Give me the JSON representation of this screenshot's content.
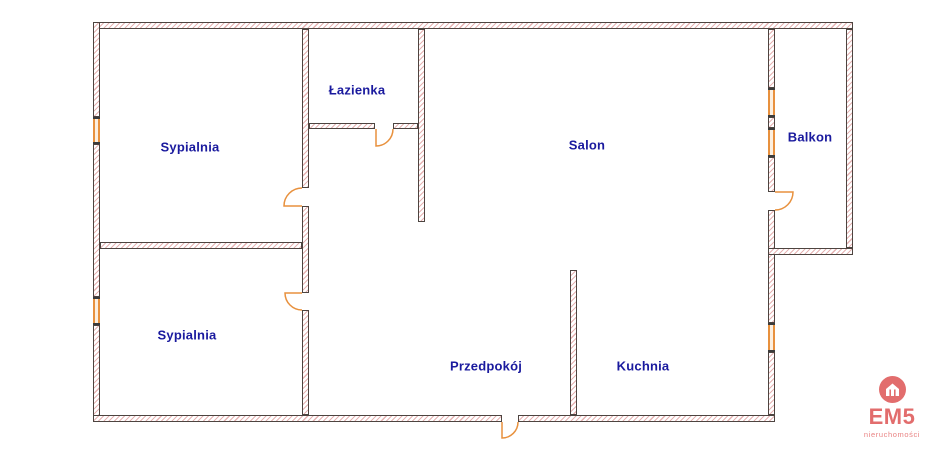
{
  "plan": {
    "rooms": [
      {
        "id": "sypialnia-gorna",
        "label": "Sypialnia"
      },
      {
        "id": "lazienka",
        "label": "Łazienka"
      },
      {
        "id": "salon",
        "label": "Salon"
      },
      {
        "id": "balkon",
        "label": "Balkon"
      },
      {
        "id": "sypialnia-dolna",
        "label": "Sypialnia"
      },
      {
        "id": "przedpokoj",
        "label": "Przedpokój"
      },
      {
        "id": "kuchnia",
        "label": "Kuchnia"
      }
    ]
  },
  "brand": {
    "name": "EM5",
    "tagline": "nieruchomości"
  },
  "colors": {
    "room_label": "#1a1a9e",
    "wall_outline": "#4d4440",
    "wall_hatch": "#e6b2b2",
    "opening_orange": "#e8913e",
    "brand": "#e26d6d"
  }
}
